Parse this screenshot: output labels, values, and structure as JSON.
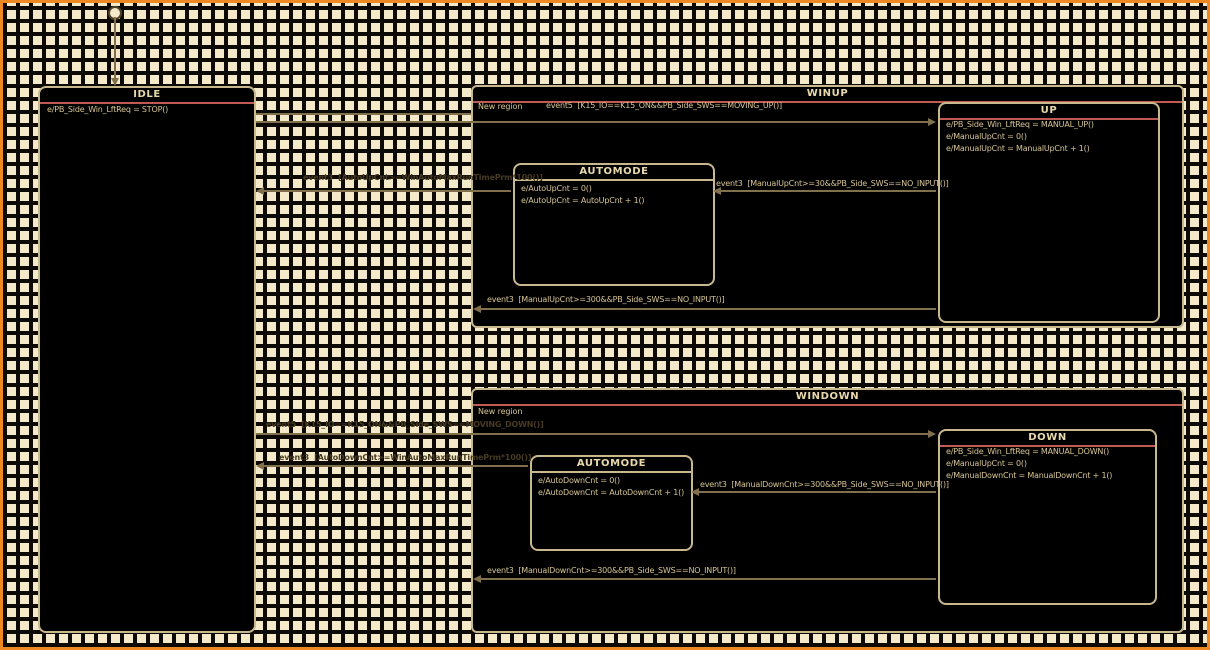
{
  "colors": {
    "frame": "#ee8822",
    "grid_background": "#f4e9c8",
    "grid_line": "#0d0a05",
    "state_background": "#000000",
    "state_border": "#c8b88e",
    "title_underline": "#c05a52",
    "state_text": "#d6c493",
    "grid_label_text": "#473a22"
  },
  "states": {
    "idle": {
      "title": "IDLE",
      "actions": [
        "e/PB_Side_Win_LftReq = STOP()"
      ]
    },
    "winup": {
      "title": "WINUP",
      "region_label": "New region"
    },
    "up": {
      "title": "UP",
      "actions": [
        "e/PB_Side_Win_LftReq = MANUAL_UP()",
        "e/ManualUpCnt = 0()",
        "e/ManualUpCnt = ManualUpCnt + 1()"
      ]
    },
    "winup_automode": {
      "title": "AUTOMODE",
      "actions": [
        "e/AutoUpCnt = 0()",
        "e/AutoUpCnt = AutoUpCnt + 1()"
      ]
    },
    "windown": {
      "title": "WINDOWN",
      "region_label": "New region"
    },
    "down": {
      "title": "DOWN",
      "actions": [
        "e/PB_Side_Win_LftReq = MANUAL_DOWN()",
        "e/ManualUpCnt = 0()",
        "e/ManualDownCnt = ManualDownCnt + 1()"
      ]
    },
    "windown_automode": {
      "title": "AUTOMODE",
      "actions": [
        "e/AutoDownCnt = 0()",
        "e/AutoDownCnt = AutoDownCnt + 1()"
      ]
    }
  },
  "transitions": {
    "idle_to_up": "event5  [K15_IO==K15_ON&&PB_Side_SWS==MOVING_UP()]",
    "winup_automode_to_idle": "event3  [AutoUpCnt>=WinAutoMaxRunTimePrm*100()]",
    "up_to_automode": "event3  [ManualUpCnt>=30&&PB_Side_SWS==NO_INPUT()]",
    "winup_exit": "event3  [ManualUpCnt>=300&&PB_Side_SWS==NO_INPUT()]",
    "idle_to_down": "event5  [K15_IO==K15_ON&&PB_Side_SWS==MOVING_DOWN()]",
    "windown_automode_to_idle": "event3  [AutoDownCnt>=WinAutoMaxRunTimePrm*100()]",
    "down_to_automode": "event3  [ManualDownCnt>=300&&PB_Side_SWS==NO_INPUT()]",
    "windown_exit": "event3  [ManualDownCnt>=300&&PB_Side_SWS==NO_INPUT()]"
  }
}
